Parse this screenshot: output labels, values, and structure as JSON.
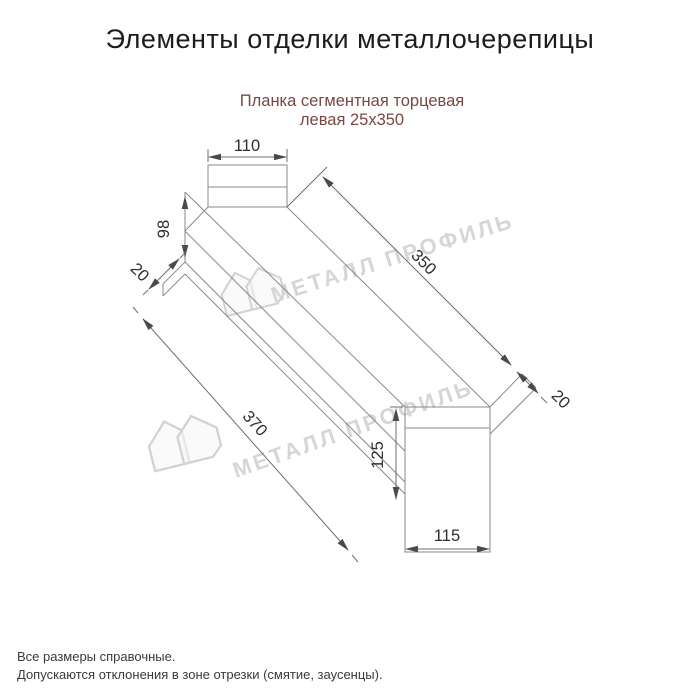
{
  "header": {
    "title": "Элементы отделки металлочерепицы"
  },
  "product": {
    "name_line1": "Планка сегментная торцевая",
    "name_line2": "левая 25х350",
    "accent_color": "#7b4742"
  },
  "drawing": {
    "type": "technical-dimension-drawing",
    "dimensions": {
      "top_width": "110",
      "left_height": "98",
      "left_lip": "20",
      "top_length": "350",
      "bottom_length": "370",
      "right_lip": "20",
      "right_height": "125",
      "bottom_width": "115"
    },
    "line_color": "#8a8a8a"
  },
  "watermark": {
    "text": "МЕТАЛЛ ПРОФИЛЬ",
    "color": "#d6d6d6"
  },
  "footer": {
    "line1": "Все размеры справочные.",
    "line2": "Допускаются отклонения в зоне отрезки (смятие, заусенцы)."
  }
}
